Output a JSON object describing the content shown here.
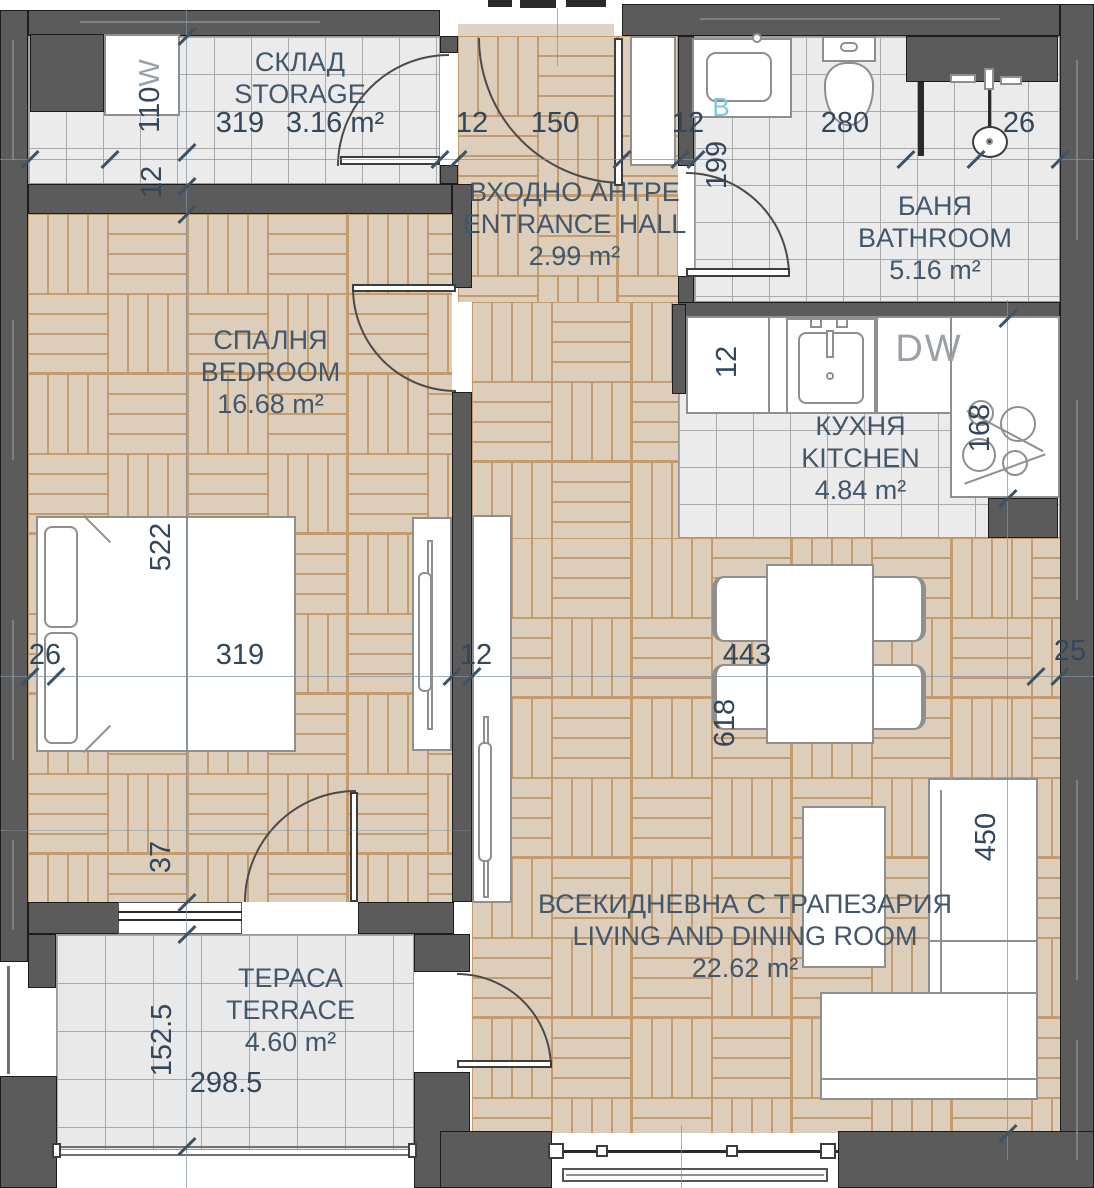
{
  "plan": {
    "rooms": [
      {
        "id": "storage",
        "name_bg": "СКЛАД",
        "name_en": "STORAGE",
        "area": "3.16 m²"
      },
      {
        "id": "entrance",
        "name_bg": "ВХОДНО АНТРЕ",
        "name_en": "ENTRANCE HALL",
        "area": "2.99 m²"
      },
      {
        "id": "bathroom",
        "name_bg": "БАНЯ",
        "name_en": "BATHROOM",
        "area": "5.16 m²"
      },
      {
        "id": "bedroom",
        "name_bg": "СПАЛНЯ",
        "name_en": "BEDROOM",
        "area": "16.68 m²"
      },
      {
        "id": "kitchen",
        "name_bg": "КУХНЯ",
        "name_en": "KITCHEN",
        "area": "4.84 m²"
      },
      {
        "id": "living",
        "name_bg": "ВСЕКИДНЕВНА С ТРАПЕЗАРИЯ",
        "name_en": "LIVING AND DINING ROOM",
        "area": "22.62 m²"
      },
      {
        "id": "terrace",
        "name_bg": "ТЕРАСА",
        "name_en": "TERRACE",
        "area": "4.60 m²"
      }
    ],
    "dimensions": {
      "d110": "110",
      "d12_storage": "12",
      "d319_storage": "319",
      "d12_hall": "12",
      "d150": "150",
      "d12_bath": "12",
      "d280": "280",
      "d26_bath": "26",
      "d199": "199",
      "d522": "522",
      "d26_bed": "26",
      "d319_bed": "319",
      "d12_mid": "12",
      "d443": "443",
      "d618": "618",
      "d25": "25",
      "d12_kitchen": "12",
      "d168": "168",
      "d37": "37",
      "d450": "450",
      "d152_5": "152.5",
      "d298_5": "298.5"
    },
    "appliances": {
      "washer_mark": "W",
      "dishwasher": "DW",
      "boiler_mark": "B"
    },
    "colors": {
      "wall": "#5b5b5b",
      "parquet": "#dccebb",
      "parquet_line": "#c49b6d",
      "tile": "#ebebeb",
      "tile_line": "#a9a9a9",
      "text": "#42576b",
      "accent_blue": "#76c9e6"
    }
  }
}
